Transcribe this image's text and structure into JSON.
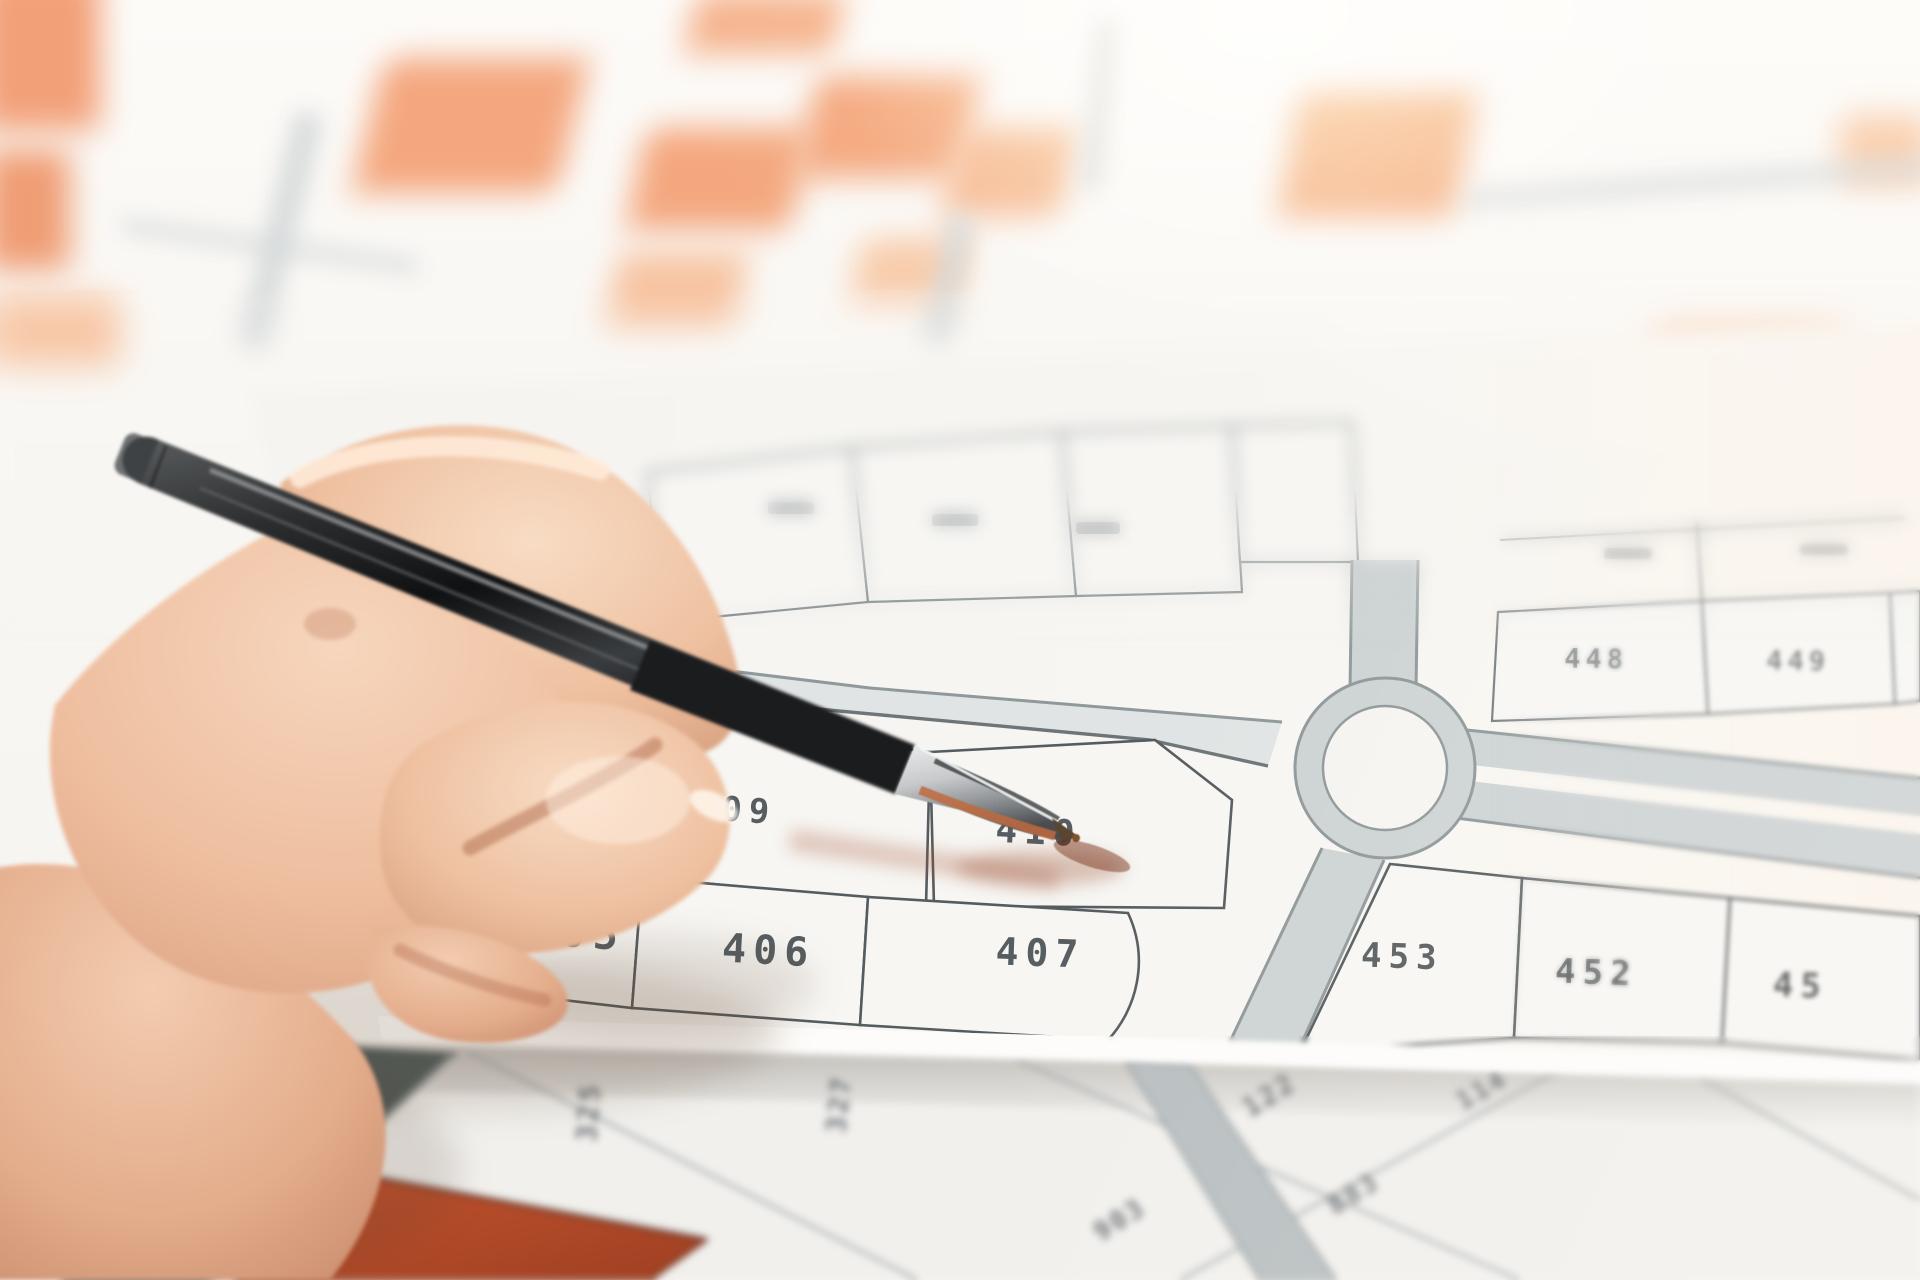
{
  "meta": {
    "alt_text": "Close-up photograph of a hand holding a black ballpoint pen, pointing at orange-highlighted land parcel 410 on a cadastral zoning map; a second blurred plat map lies underneath."
  },
  "main_sheet": {
    "parcels": [
      {
        "id": "parcel-409",
        "label": "09",
        "highlighted": false,
        "partial": true
      },
      {
        "id": "parcel-410",
        "label": "410",
        "highlighted": true,
        "partial": false
      },
      {
        "id": "parcel-405",
        "label": "05",
        "highlighted": false,
        "partial": true
      },
      {
        "id": "parcel-406",
        "label": "406",
        "highlighted": false,
        "partial": false
      },
      {
        "id": "parcel-407",
        "label": "407",
        "highlighted": false,
        "partial": false
      },
      {
        "id": "parcel-453",
        "label": "453",
        "highlighted": false,
        "partial": false
      },
      {
        "id": "parcel-452",
        "label": "452",
        "highlighted": false,
        "partial": false
      },
      {
        "id": "parcel-451",
        "label": "45",
        "highlighted": false,
        "partial": true
      },
      {
        "id": "parcel-448",
        "label": "448",
        "highlighted": true,
        "partial": false
      },
      {
        "id": "parcel-449",
        "label": "449",
        "highlighted": false,
        "partial": false
      }
    ],
    "features": [
      "roundabout",
      "roads"
    ]
  },
  "lower_sheet": {
    "labels": [
      {
        "text": "325"
      },
      {
        "text": "327"
      },
      {
        "text": "122"
      },
      {
        "text": "903"
      },
      {
        "text": "883"
      },
      {
        "text": "114"
      }
    ]
  },
  "palette": {
    "highlight_orange": "#ef9166",
    "highlight_orange_soft": "#f3b490",
    "paper": "#f7f6f3",
    "paper_lower": "#f1f0ed",
    "road_gray": "#cdd3d4",
    "road_casing": "#8f989b",
    "lot_line": "#555c60",
    "label_gray": "#565d61",
    "red_brown_lot": "#c4552f",
    "dark_stripe": "#4f5b59",
    "pen_black": "#1f2022",
    "skin_tone": "#eebd9e",
    "glow_warm": "#ffd8a8"
  }
}
